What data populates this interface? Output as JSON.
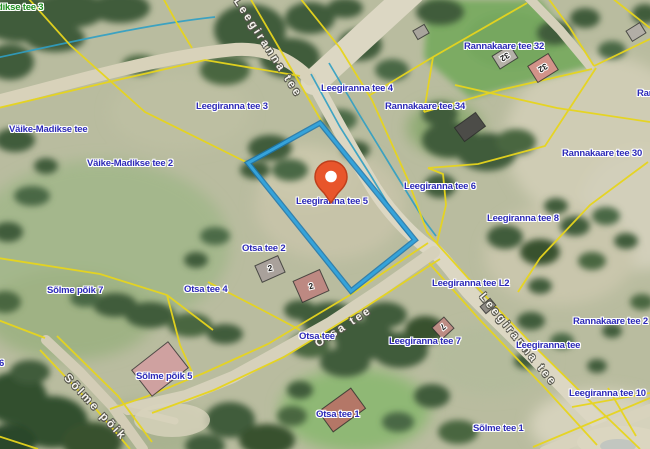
{
  "labels": {
    "addresses": [
      {
        "text": "dikse tee 3",
        "color": "green"
      },
      {
        "text": "Leegiranna tee 3",
        "color": "blue"
      },
      {
        "text": "Leegiranna tee 4",
        "color": "blue"
      },
      {
        "text": "Rannakaare tee 32",
        "color": "blue"
      },
      {
        "text": "Rannakaare tee 34",
        "color": "blue"
      },
      {
        "text": "Rannakaare tee 30",
        "color": "blue"
      },
      {
        "text": "Rannakaare te",
        "color": "blue"
      },
      {
        "text": "Väike-Madikse tee",
        "color": "blue"
      },
      {
        "text": "Väike-Madikse tee 2",
        "color": "blue"
      },
      {
        "text": "Leegiranna tee 5",
        "color": "blue"
      },
      {
        "text": "Leegiranna tee 6",
        "color": "blue"
      },
      {
        "text": "Leegiranna tee 8",
        "color": "blue"
      },
      {
        "text": "Otsa tee 2",
        "color": "blue"
      },
      {
        "text": "Otsa tee 4",
        "color": "blue"
      },
      {
        "text": "Sõlme põik 7",
        "color": "blue"
      },
      {
        "text": "Sõlme põik 5",
        "color": "blue"
      },
      {
        "text": "Otsa tee",
        "color": "blue"
      },
      {
        "text": "Leegiranna tee L2",
        "color": "blue"
      },
      {
        "text": "Leegiranna tee 7",
        "color": "blue"
      },
      {
        "text": "Rannakaare tee 2",
        "color": "blue"
      },
      {
        "text": "Leegiranna tee",
        "color": "blue"
      },
      {
        "text": "Leegiranna tee 10",
        "color": "blue"
      },
      {
        "text": "Sõlme tee 1",
        "color": "blue"
      },
      {
        "text": "Otsa tee 1",
        "color": "blue"
      },
      {
        "text": "6",
        "color": "blue"
      }
    ],
    "streets": [
      "Leegiranna tee",
      "Otsa tee",
      "Sõlme põik",
      "Leegiranna tee"
    ]
  },
  "buildings": {
    "numbers": [
      "32",
      "32",
      "2",
      "2",
      "7"
    ]
  },
  "highlighted_parcel": {
    "address": "Leegiranna tee 5",
    "outline_color": "#2e9bd6"
  },
  "marker": {
    "type": "location-pin",
    "color": "#e8552b"
  },
  "palette": {
    "cadastral_line": "#e7d51d",
    "address_label_blue": "#2d2ab8",
    "address_label_green": "#1d8f1d",
    "street_label": "#f6f4ee",
    "ditch_line": "#2f9fc4",
    "road_fill": "#dcd7c3"
  }
}
